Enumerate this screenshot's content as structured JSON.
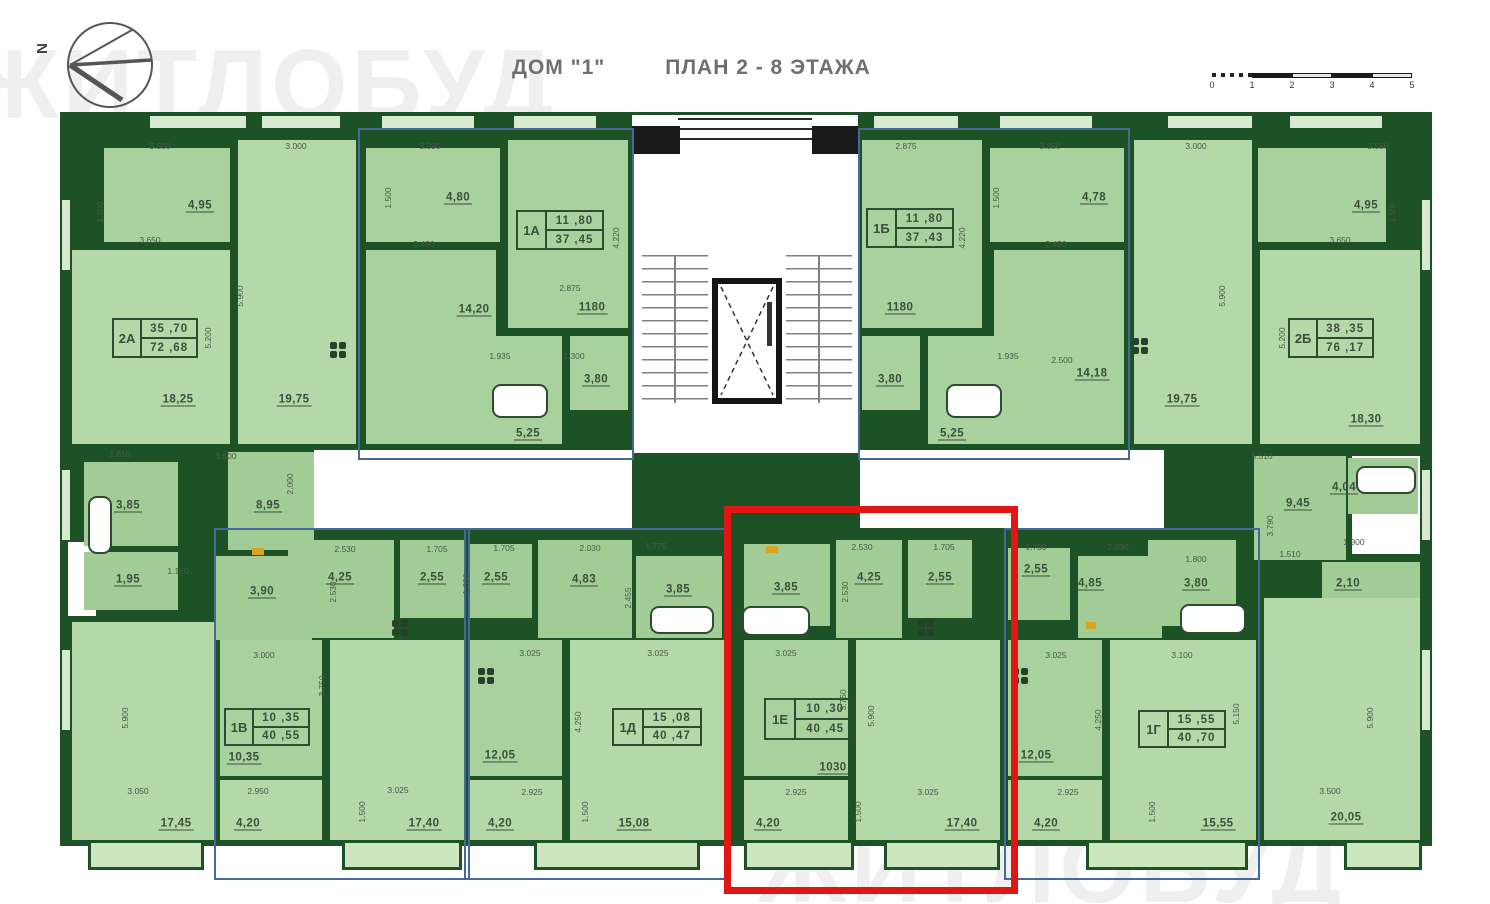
{
  "header": {
    "house_label": "ДОМ \"1\"",
    "plan_label": "ПЛАН 2 - 8 ЭТАЖА"
  },
  "compass": {
    "north_label": "N"
  },
  "watermark": {
    "top_text": "ЖИТЛОБУД",
    "bottom_text": "ЖИТЛОБУД"
  },
  "scale_bar": {
    "ticks": [
      "0",
      "1",
      "2",
      "3",
      "4",
      "5"
    ]
  },
  "apartments": {
    "a2a": {
      "code": "2А",
      "living_area": "35 ,70",
      "total_area": "72 ,68"
    },
    "a1a": {
      "code": "1А",
      "living_area": "11 ,80",
      "total_area": "37 ,45"
    },
    "a1b": {
      "code": "1Б",
      "living_area": "11 ,80",
      "total_area": "37 ,43"
    },
    "a2b": {
      "code": "2Б",
      "living_area": "38 ,35",
      "total_area": "76 ,17"
    },
    "a1v": {
      "code": "1В",
      "living_area": "10 ,35",
      "total_area": "40 ,55"
    },
    "a1d": {
      "code": "1Д",
      "living_area": "15 ,08",
      "total_area": "40 ,47"
    },
    "a1e": {
      "code": "1Е",
      "living_area": "10 ,30",
      "total_area": "40 ,45"
    },
    "a1g": {
      "code": "1Г",
      "living_area": "15 ,55",
      "total_area": "40 ,70"
    }
  },
  "rooms": {
    "a2a_bed": "4,95",
    "a2a_living": "18,25",
    "a2a_kitchen": "19,75",
    "a2a_room2": "17,45",
    "a1a_entry": "4,80",
    "a1a_kitchen": "14,20",
    "a1a_room": "1180",
    "a1a_wc": "3,80",
    "a1a_bath": "5,25",
    "a1b_room": "1180",
    "a1b_entry": "4,78",
    "a1b_kitchen": "14,18",
    "a1b_wc": "3,80",
    "a1b_bath": "5,25",
    "a2b_kitchen": "19,75",
    "a2b_bed": "4,95",
    "a2b_living": "18,30",
    "a2b_room2": "20,05",
    "m_385": "3,85",
    "m_895": "8,95",
    "m_195": "1,95",
    "m_390": "3,90",
    "m_945": "9,45",
    "m_404": "4,04",
    "m_210": "2,10",
    "a1v_hall": "4,25",
    "a1v_wc": "2,55",
    "a1v_bed": "10,35",
    "a1v_balc": "4,20",
    "a1v_living": "17,40",
    "a1d_wc": "2,55",
    "a1d_hall": "4,83",
    "a1d_bath": "3,85",
    "a1d_kitchen": "12,05",
    "a1d_balc": "4,20",
    "a1d_living": "15,08",
    "a1e_bath": "3,85",
    "a1e_hall": "4,25",
    "a1e_wc": "2,55",
    "a1e_bed": "1030",
    "a1e_balc": "4,20",
    "a1e_living": "17,40",
    "a1g_wc": "2,55",
    "a1g_hall": "4,85",
    "a1g_bath": "3,80",
    "a1g_kitchen": "12,05",
    "a1g_balc": "4,20",
    "a1g_living": "15,55"
  },
  "dims": {
    "t1": "3.550",
    "t2": "3.000",
    "t3": "3.390",
    "t4": "2.875",
    "t5": "3.350",
    "t6": "3.000",
    "t7": "3.550",
    "v1": "1.500",
    "v2": "5.900",
    "v3": "5.200",
    "v4": "1.500",
    "v5": "4.220",
    "v6": "1.500",
    "v7": "4.220",
    "v8": "5.900",
    "v9": "5.200",
    "v16": "1.500",
    "m1": "3.650",
    "m2": "3.490",
    "m3": "2.875",
    "m4": "1.935",
    "m5": "1.300",
    "m6": "2.450",
    "m7": "2.500",
    "m8": "1.935",
    "m9": "3.650",
    "l1": "1.610",
    "l2": "3.600",
    "l3": "2.000",
    "l4": "1.150",
    "l5": "2.530",
    "l6": "1.705",
    "l7": "1.705",
    "l8": "2.030",
    "l9": "1.775",
    "l10": "2.530",
    "l11": "1.705",
    "l12": "1.700",
    "l13": "2.030",
    "l14": "1.800",
    "r1": "5.510",
    "r2": "3.790",
    "r3": "1.510",
    "r4": "1.900",
    "b1": "3.000",
    "b2": "3.750",
    "b3": "3.025",
    "b4": "3.025",
    "b5": "3.025",
    "b6": "3.100",
    "b7": "3.025",
    "b8": "4.250",
    "b9": "4.250",
    "b10": "5.900",
    "b11": "5.900",
    "b12": "5.150",
    "b13": "5.900",
    "b14": "3.050",
    "b15": "2.950",
    "b16": "3.025",
    "b17": "2.925",
    "b18": "2.925",
    "b19": "3.025",
    "b20": "2.925",
    "b21": "3.500",
    "b22": "1.500",
    "b23": "1.500",
    "b24": "1.500",
    "b25": "1.500",
    "v11": "2.455",
    "v12": "1.600",
    "v13": "2.530",
    "v14": "2.530",
    "v15": "3.750"
  }
}
